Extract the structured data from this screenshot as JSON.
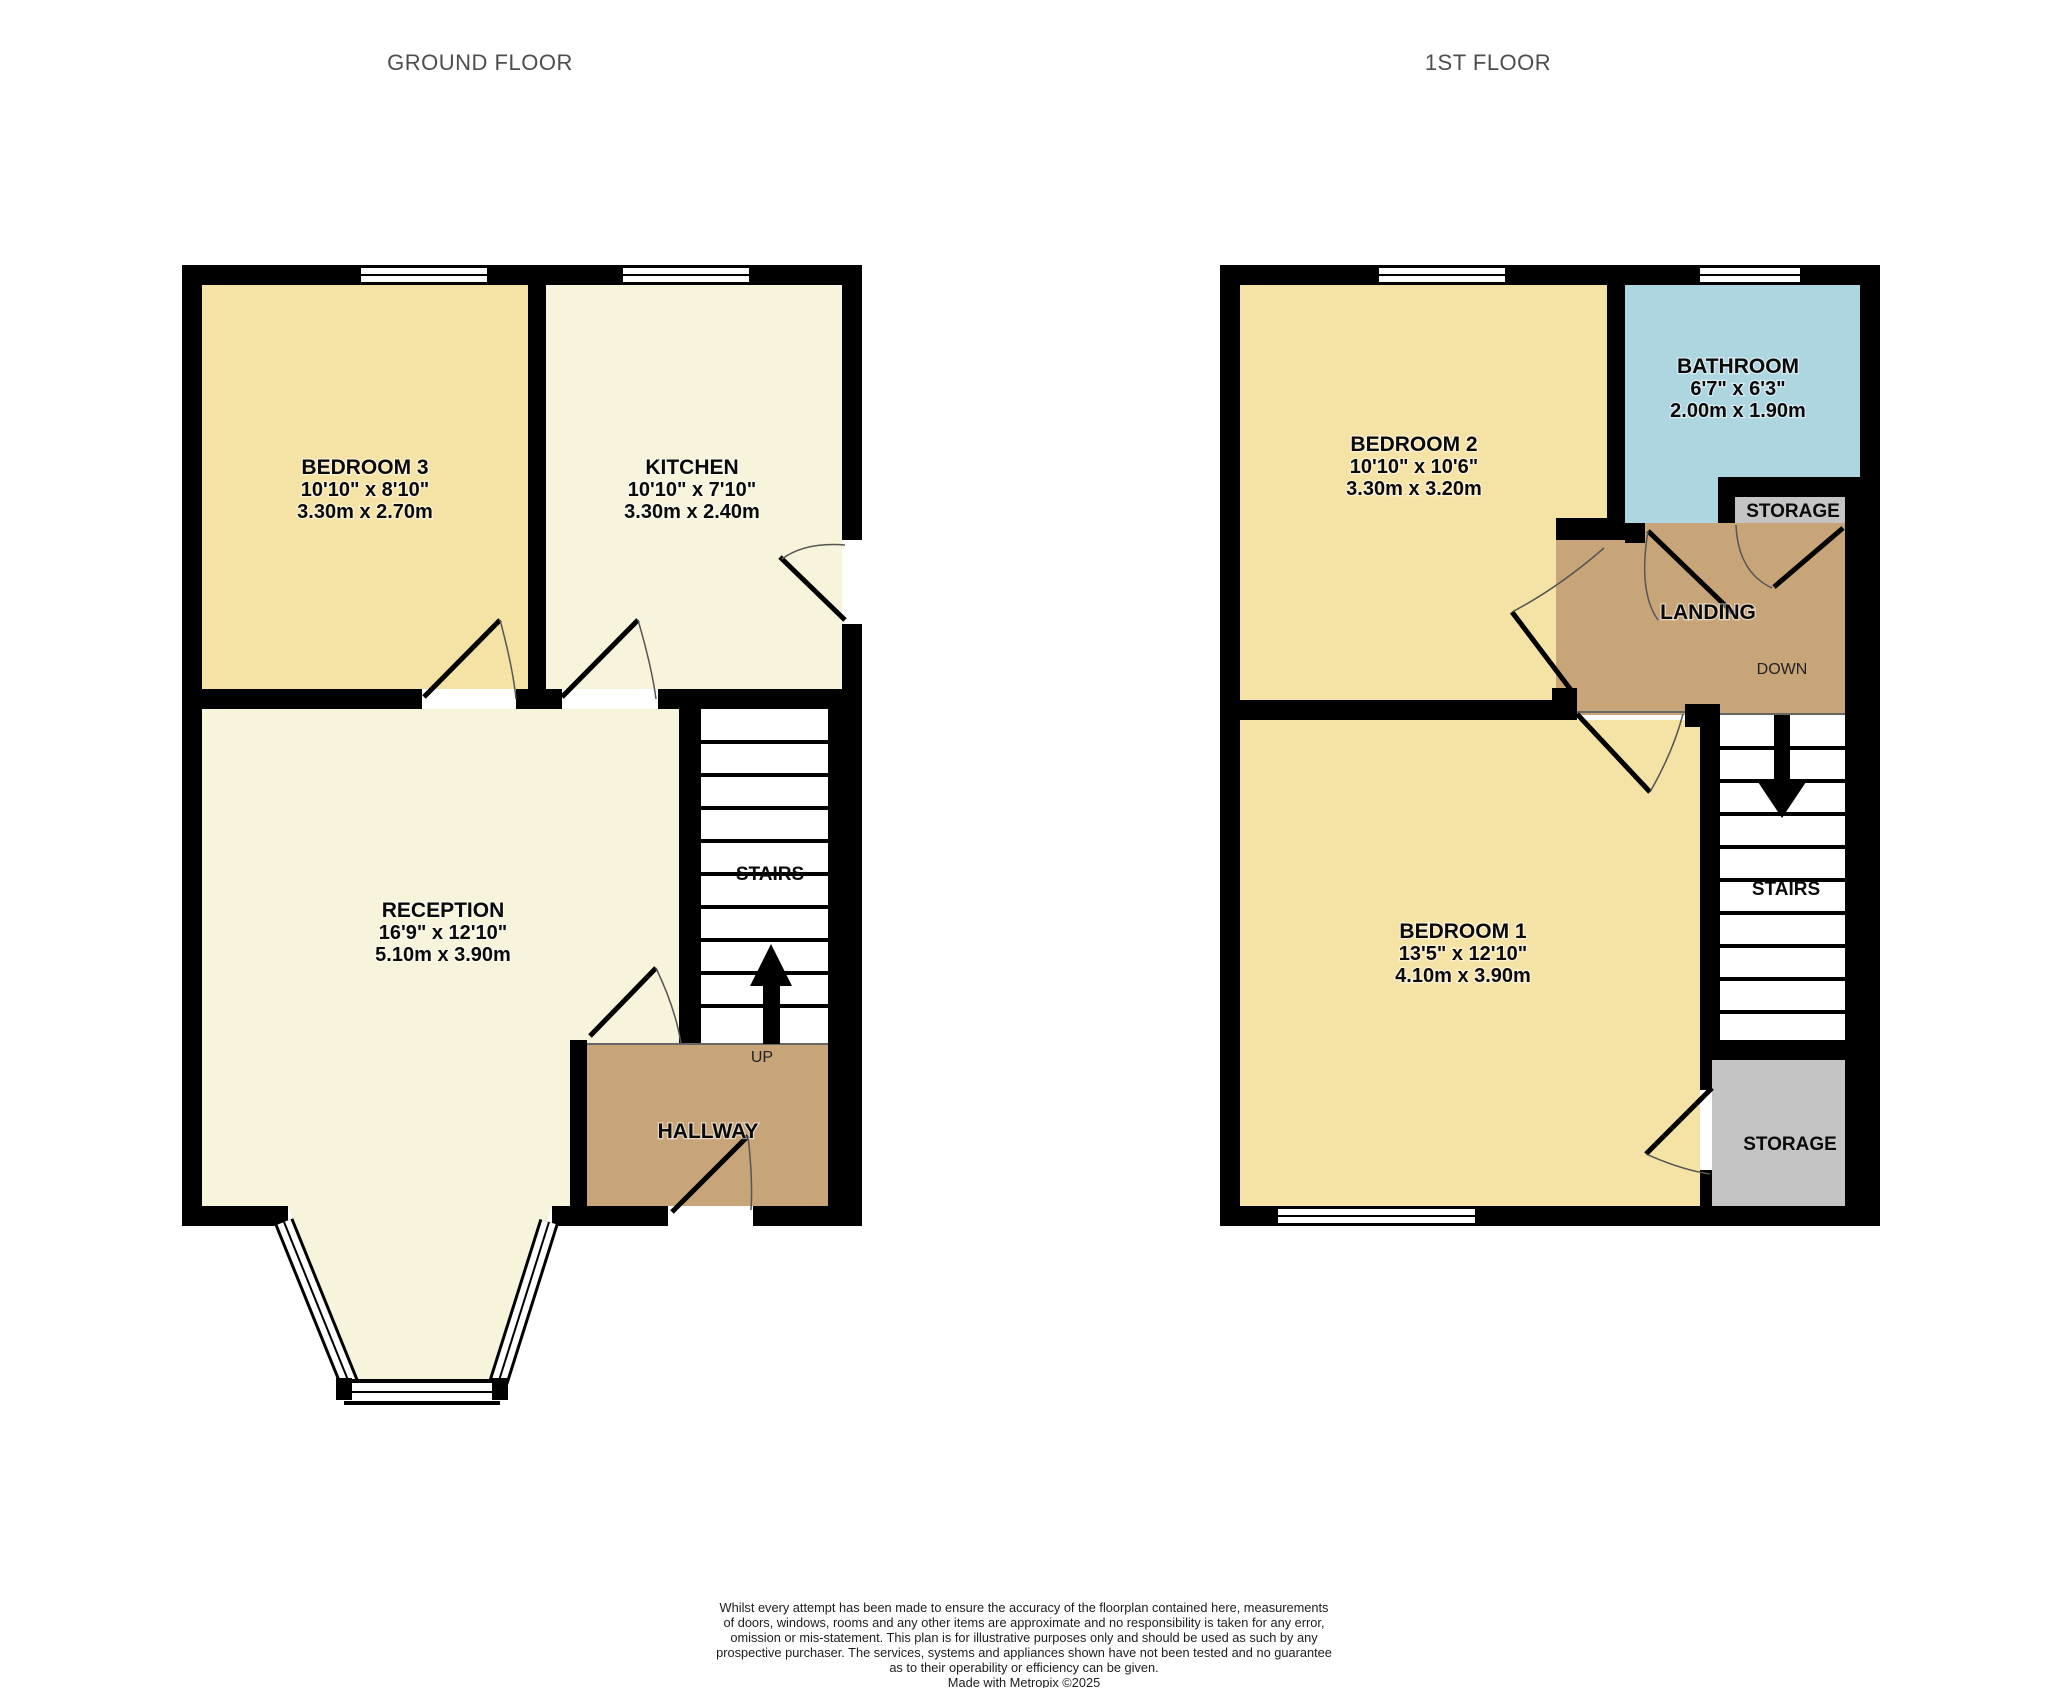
{
  "titles": {
    "ground_floor": "GROUND FLOOR",
    "first_floor": "1ST FLOOR"
  },
  "ground_floor": {
    "bedroom3": {
      "name": "BEDROOM 3",
      "imperial": "10'10\"  x 8'10\"",
      "metric": "3.30m  x 2.70m"
    },
    "kitchen": {
      "name": "KITCHEN",
      "imperial": "10'10\"  x 7'10\"",
      "metric": "3.30m  x 2.40m"
    },
    "reception": {
      "name": "RECEPTION",
      "imperial": "16'9\"  x 12'10\"",
      "metric": "5.10m  x 3.90m"
    },
    "stairs_label": "STAIRS",
    "up_label": "UP",
    "hallway_label": "HALLWAY"
  },
  "first_floor": {
    "bedroom2": {
      "name": "BEDROOM 2",
      "imperial": "10'10\"  x 10'6\"",
      "metric": "3.30m  x 3.20m"
    },
    "bathroom": {
      "name": "BATHROOM",
      "imperial": "6'7\"  x 6'3\"",
      "metric": "2.00m  x 1.90m"
    },
    "bedroom1": {
      "name": "BEDROOM 1",
      "imperial": "13'5\"  x 12'10\"",
      "metric": "4.10m  x 3.90m"
    },
    "storage_top_label": "STORAGE",
    "landing_label": "LANDING",
    "down_label": "DOWN",
    "stairs_label": "STAIRS",
    "storage_bottom_label": "STORAGE"
  },
  "disclaimer": {
    "line1": "Whilst every attempt has been made to ensure the accuracy of the floorplan contained here, measurements",
    "line2": "of doors, windows, rooms and any other items are approximate and no responsibility is taken for any error,",
    "line3": "omission or mis-statement. This plan is for illustrative purposes only and should be used as such by any",
    "line4": "prospective purchaser. The services, systems and appliances shown have not been tested and no guarantee",
    "line5": "as to their operability or efficiency can be given.",
    "line6": "Made with Metropix ©2025"
  },
  "colors": {
    "room_yellow": "#F5E3A6",
    "room_cream": "#F8F3DB",
    "hall_tan": "#C7A579",
    "bath_blue": "#ADD6E0",
    "storage_gray": "#C4C4C4",
    "wall": "#000000",
    "title_gray": "#4D4D4D"
  }
}
